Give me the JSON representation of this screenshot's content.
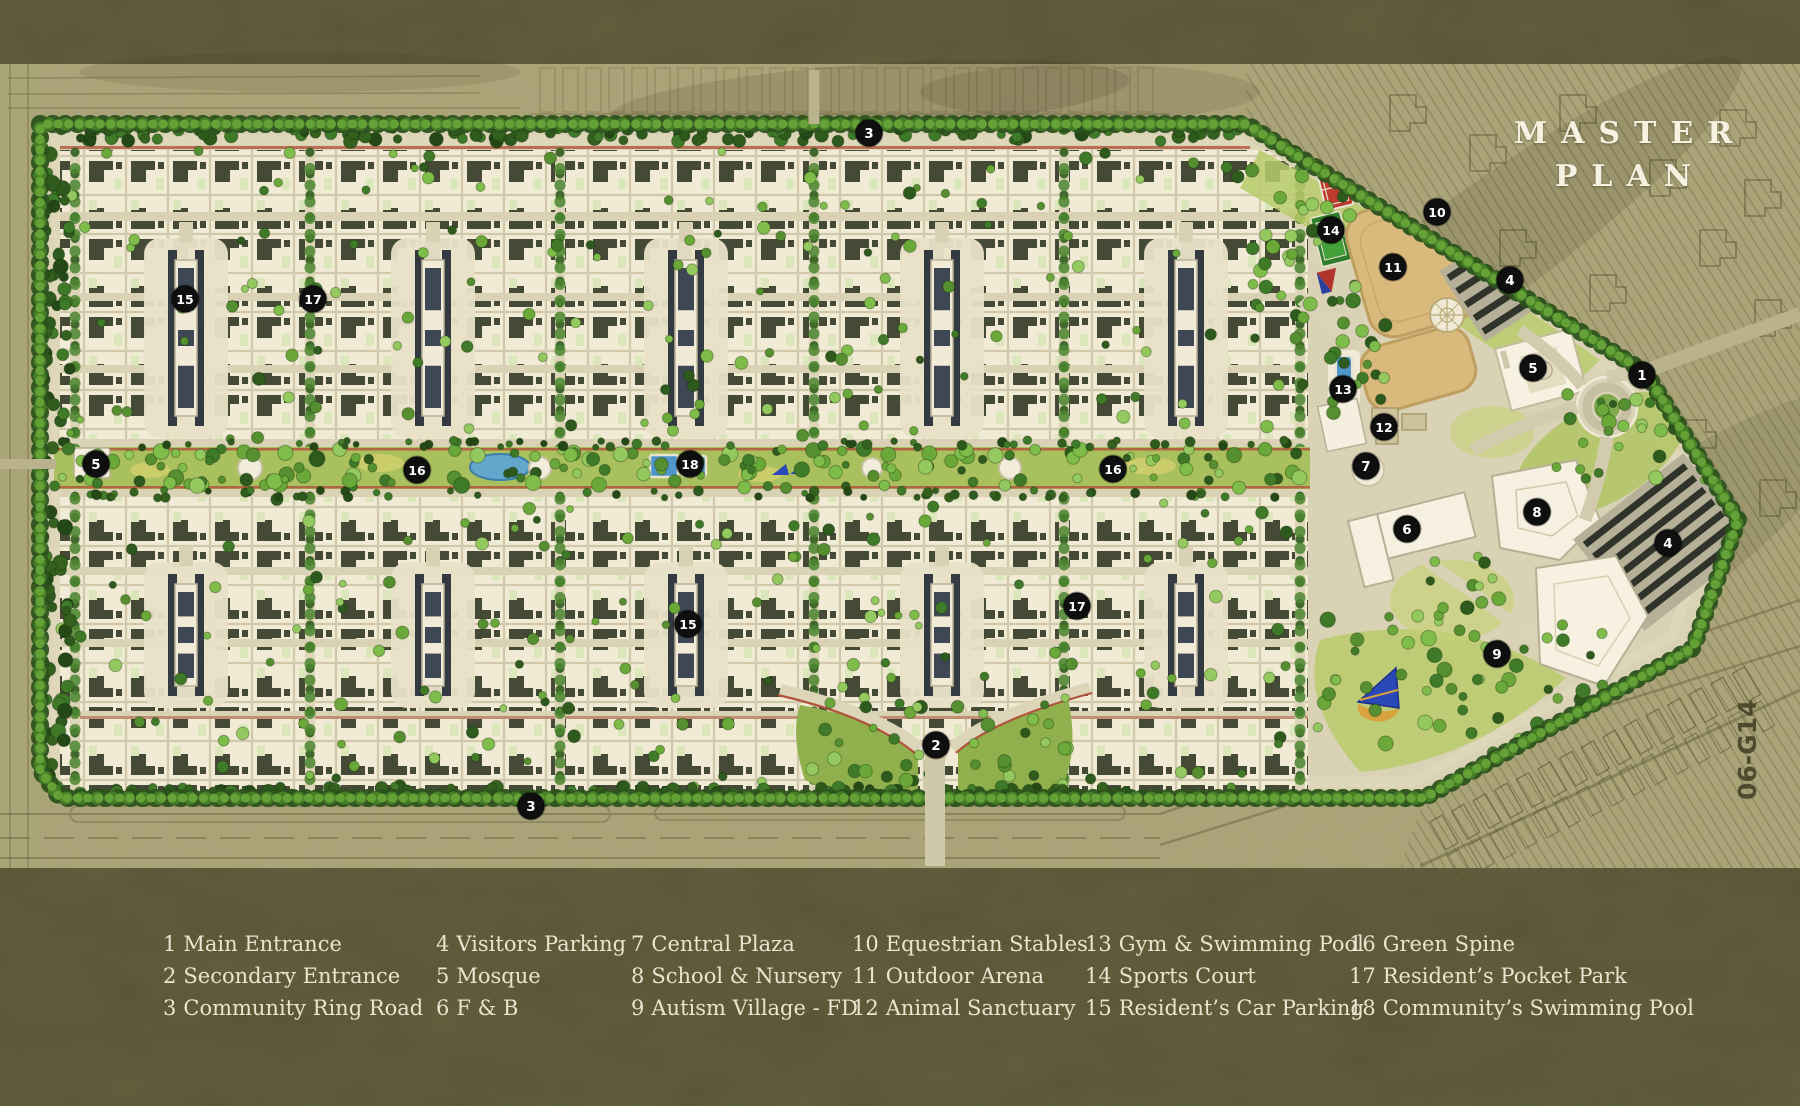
{
  "title": {
    "line1": "MASTER",
    "line2": "PLAN"
  },
  "legend": {
    "items": [
      {
        "num": "1",
        "label": "Main Entrance"
      },
      {
        "num": "2",
        "label": "Secondary Entrance"
      },
      {
        "num": "3",
        "label": "Community Ring Road"
      },
      {
        "num": "4",
        "label": "Visitors Parking"
      },
      {
        "num": "5",
        "label": "Mosque"
      },
      {
        "num": "6",
        "label": "F & B"
      },
      {
        "num": "7",
        "label": "Central Plaza"
      },
      {
        "num": "8",
        "label": "School & Nursery"
      },
      {
        "num": "9",
        "label": "Autism Village - FD"
      },
      {
        "num": "10",
        "label": "Equestrian Stables"
      },
      {
        "num": "11",
        "label": "Outdoor Arena"
      },
      {
        "num": "12",
        "label": "Animal Sanctuary"
      },
      {
        "num": "13",
        "label": "Gym & Swimming Pool"
      },
      {
        "num": "14",
        "label": "Sports Court"
      },
      {
        "num": "15",
        "label": "Resident’s Car Parking"
      },
      {
        "num": "16",
        "label": "Green Spine"
      },
      {
        "num": "17",
        "label": "Resident’s Pocket Park"
      },
      {
        "num": "18",
        "label": "Community’s Swimming Pool"
      }
    ]
  },
  "map": {
    "parcel_label": "06-G14",
    "markers": [
      {
        "n": "1",
        "x": 1642,
        "y": 375
      },
      {
        "n": "2",
        "x": 936,
        "y": 745
      },
      {
        "n": "3",
        "x": 869,
        "y": 133
      },
      {
        "n": "3",
        "x": 531,
        "y": 806
      },
      {
        "n": "4",
        "x": 1510,
        "y": 280
      },
      {
        "n": "4",
        "x": 1668,
        "y": 543
      },
      {
        "n": "5",
        "x": 96,
        "y": 464
      },
      {
        "n": "5",
        "x": 1533,
        "y": 368
      },
      {
        "n": "6",
        "x": 1407,
        "y": 529
      },
      {
        "n": "7",
        "x": 1366,
        "y": 466
      },
      {
        "n": "8",
        "x": 1537,
        "y": 512
      },
      {
        "n": "9",
        "x": 1497,
        "y": 654
      },
      {
        "n": "10",
        "x": 1437,
        "y": 212
      },
      {
        "n": "11",
        "x": 1393,
        "y": 267
      },
      {
        "n": "12",
        "x": 1384,
        "y": 427
      },
      {
        "n": "13",
        "x": 1343,
        "y": 389
      },
      {
        "n": "14",
        "x": 1331,
        "y": 230
      },
      {
        "n": "15",
        "x": 185,
        "y": 299
      },
      {
        "n": "15",
        "x": 688,
        "y": 624
      },
      {
        "n": "16",
        "x": 417,
        "y": 470
      },
      {
        "n": "16",
        "x": 1113,
        "y": 469
      },
      {
        "n": "17",
        "x": 313,
        "y": 299
      },
      {
        "n": "17",
        "x": 1077,
        "y": 606
      },
      {
        "n": "18",
        "x": 690,
        "y": 464
      }
    ],
    "colors": {
      "background": "#4a4627",
      "marker_bg": "#0f0f0f",
      "marker_text": "#ffffff",
      "title_text": "#f6f2e2",
      "legend_text": "#e9e4cf",
      "community_ground": "#d9d2b4",
      "tree_green": "#4f8a2c",
      "spine_green": "#a8c05d",
      "arena_sand": "#d9b97c",
      "court_red": "#bf3a2e",
      "court_green": "#2f7d2c",
      "pool_blue": "#4f97c9"
    }
  }
}
